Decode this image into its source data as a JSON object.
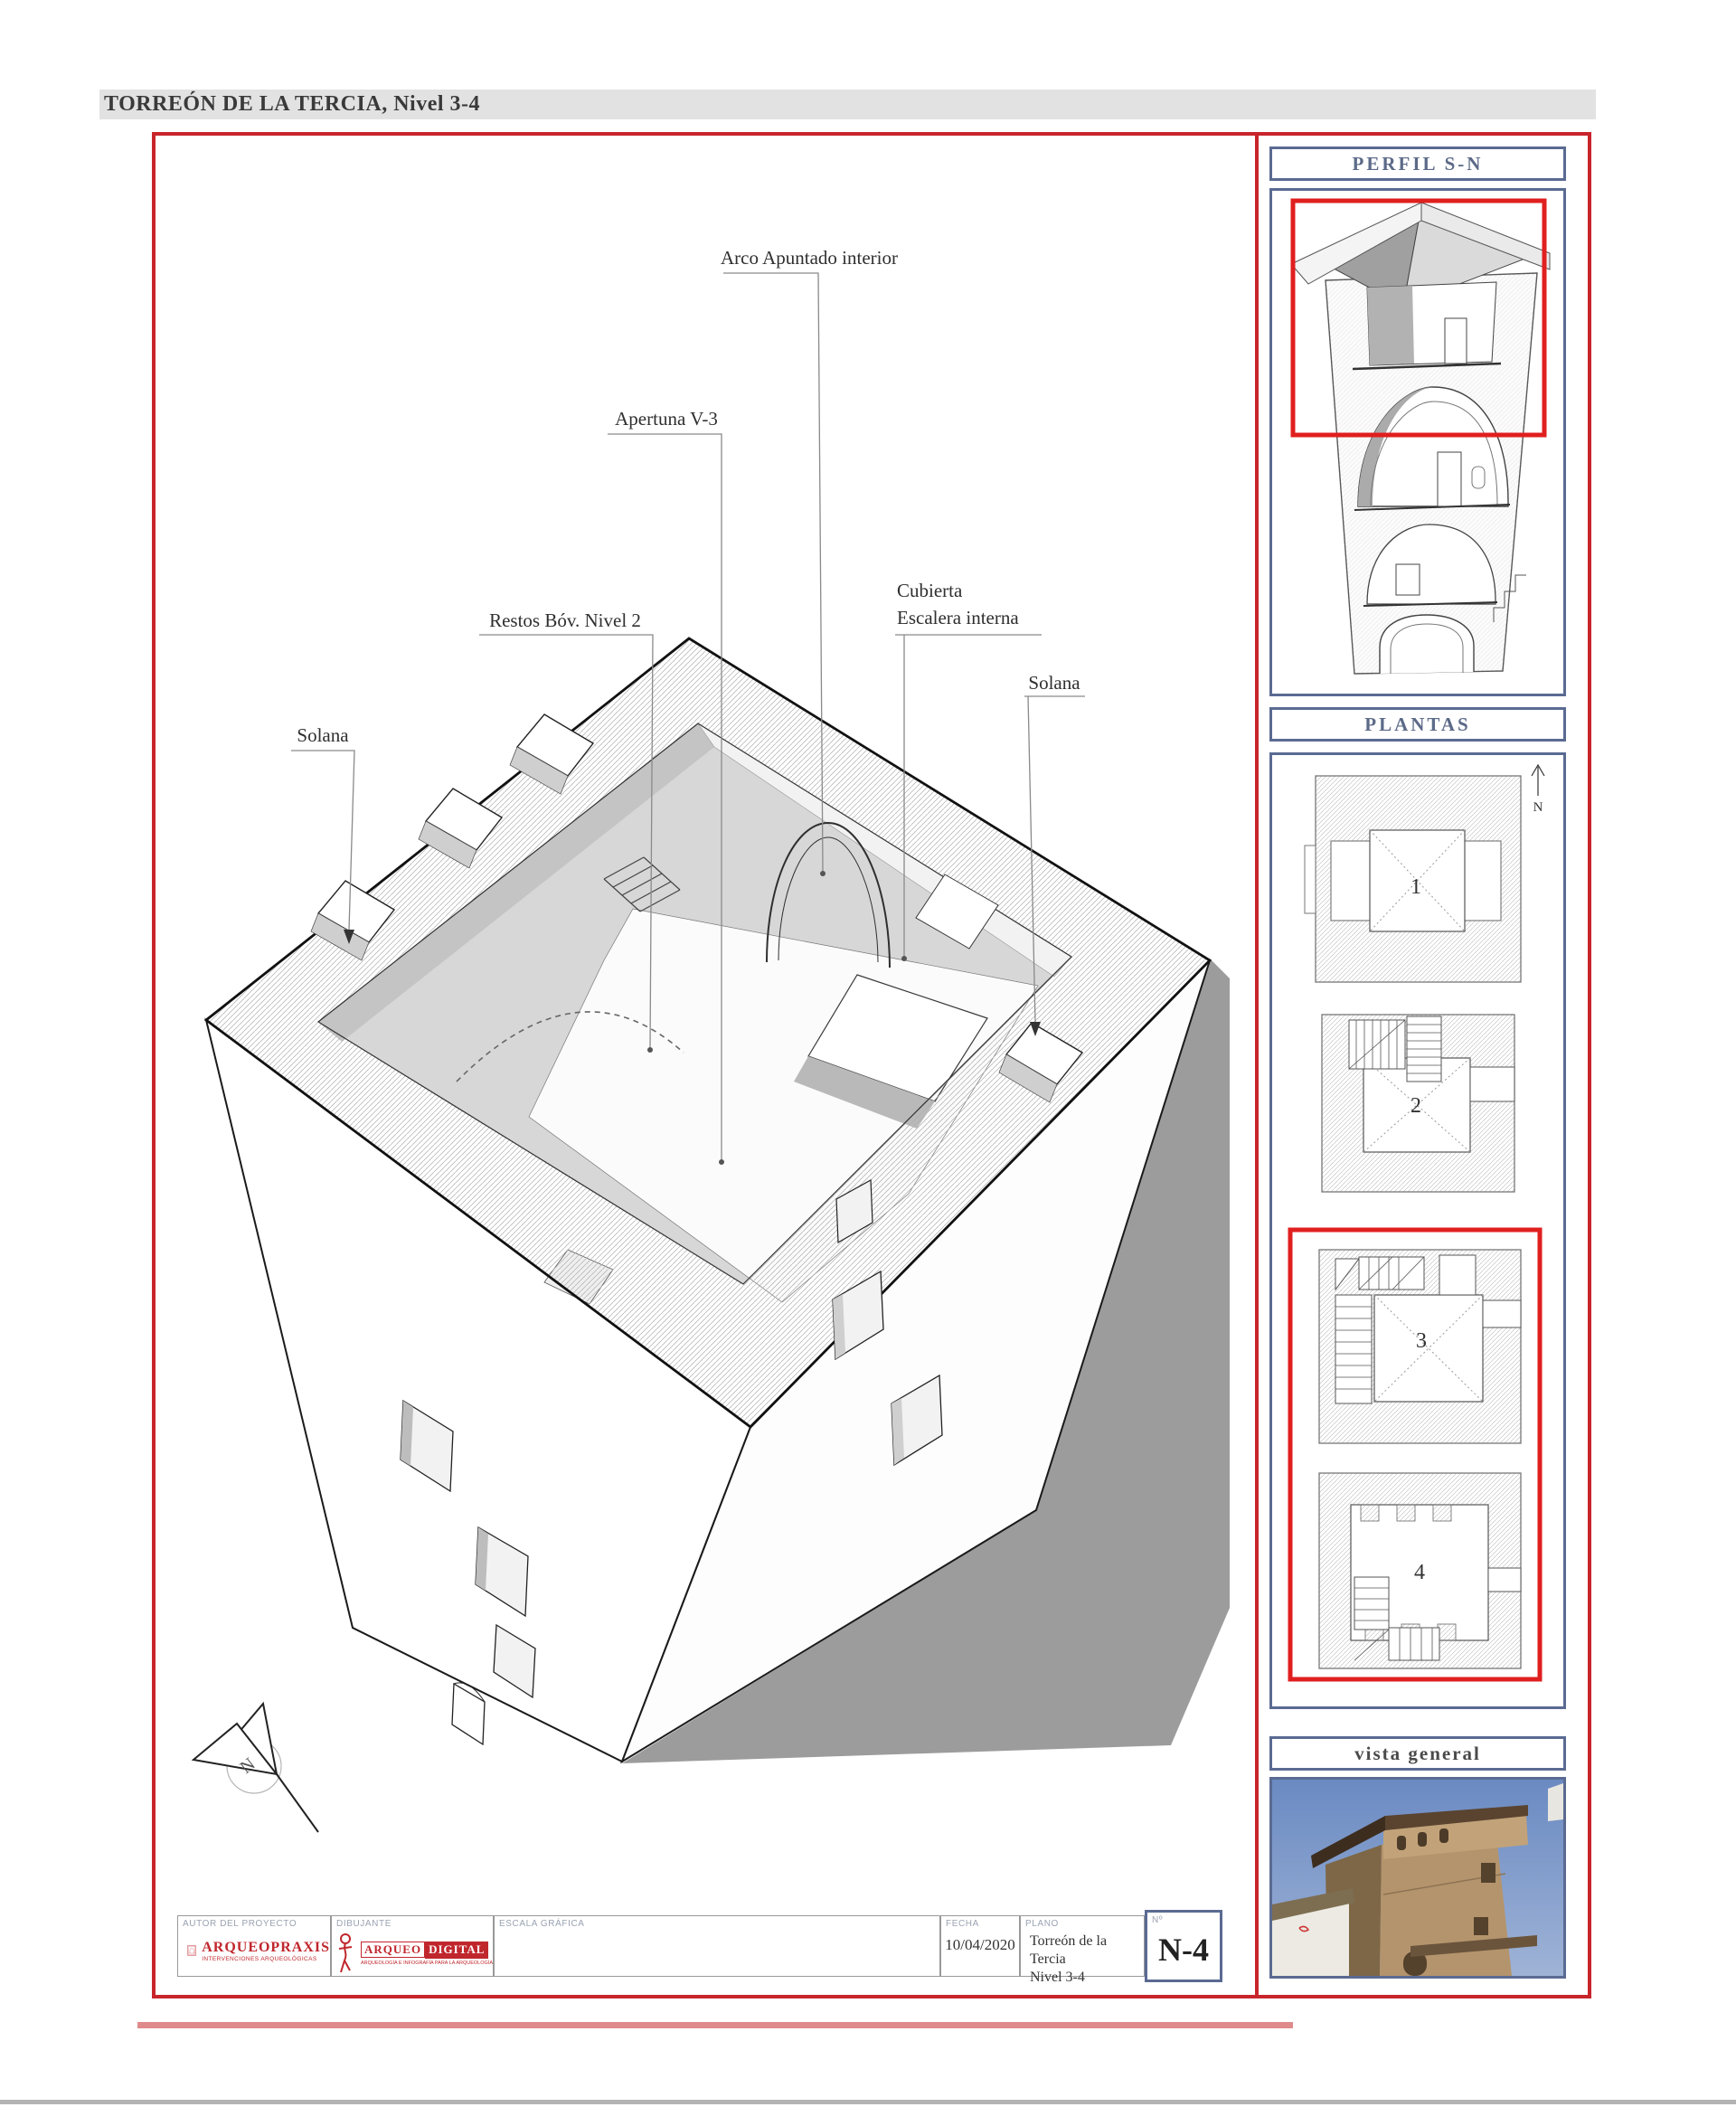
{
  "page": {
    "title": "TORREÓN DE LA TERCIA, Nivel 3-4"
  },
  "main_drawing": {
    "labels": {
      "arco": "Arco Apuntado interior",
      "apertura": "Apertuna V-3",
      "restos": "Restos Bóv. Nivel 2",
      "cubierta_line1": "Cubierta",
      "cubierta_line2": "Escalera interna",
      "solana_left": "Solana",
      "solana_right": "Solana"
    },
    "north_label": "N"
  },
  "sidebar": {
    "perfil": {
      "title": "PERFIL S-N"
    },
    "plantas": {
      "title": "PLANTAS",
      "north_label": "N",
      "plans": [
        {
          "number": "1"
        },
        {
          "number": "2"
        },
        {
          "number": "3"
        },
        {
          "number": "4"
        }
      ],
      "highlighted_plans": "3-4"
    },
    "vista": {
      "title": "vista general"
    }
  },
  "titleblock": {
    "autor_label": "AUTOR DEL PROYECTO",
    "dibujante_label": "DIBUJANTE",
    "escala_label": "ESCALA GRÁFICA",
    "fecha_label": "FECHA",
    "fecha_value": "10/04/2020",
    "plano_label": "PLANO",
    "plano_value_line1": "Torreón de la Tercia",
    "plano_value_line2": "Nivel 3-4",
    "numero_label": "Nº",
    "numero_value": "N-4",
    "arqueopraxis": {
      "name": "ARQUEOPRAXIS",
      "subtitle": "INTERVENCIONES ARQUEOLÓGICAS"
    },
    "arqueodigital": {
      "name_part1": "ARQUEO",
      "name_part2": "DIGITAL",
      "subtitle": "ARQUEOLOGÍA E INFOGRAFÍA PARA LA ARQUEOLOGÍA"
    }
  },
  "colors": {
    "frame_red": "#c8252b",
    "highlight_red": "#e01f1f",
    "panel_blue": "#5a6a92",
    "bar_grey": "#e2e2e2",
    "light_red_bar": "#e08b8b",
    "shadow_grey": "#9c9c9c"
  }
}
